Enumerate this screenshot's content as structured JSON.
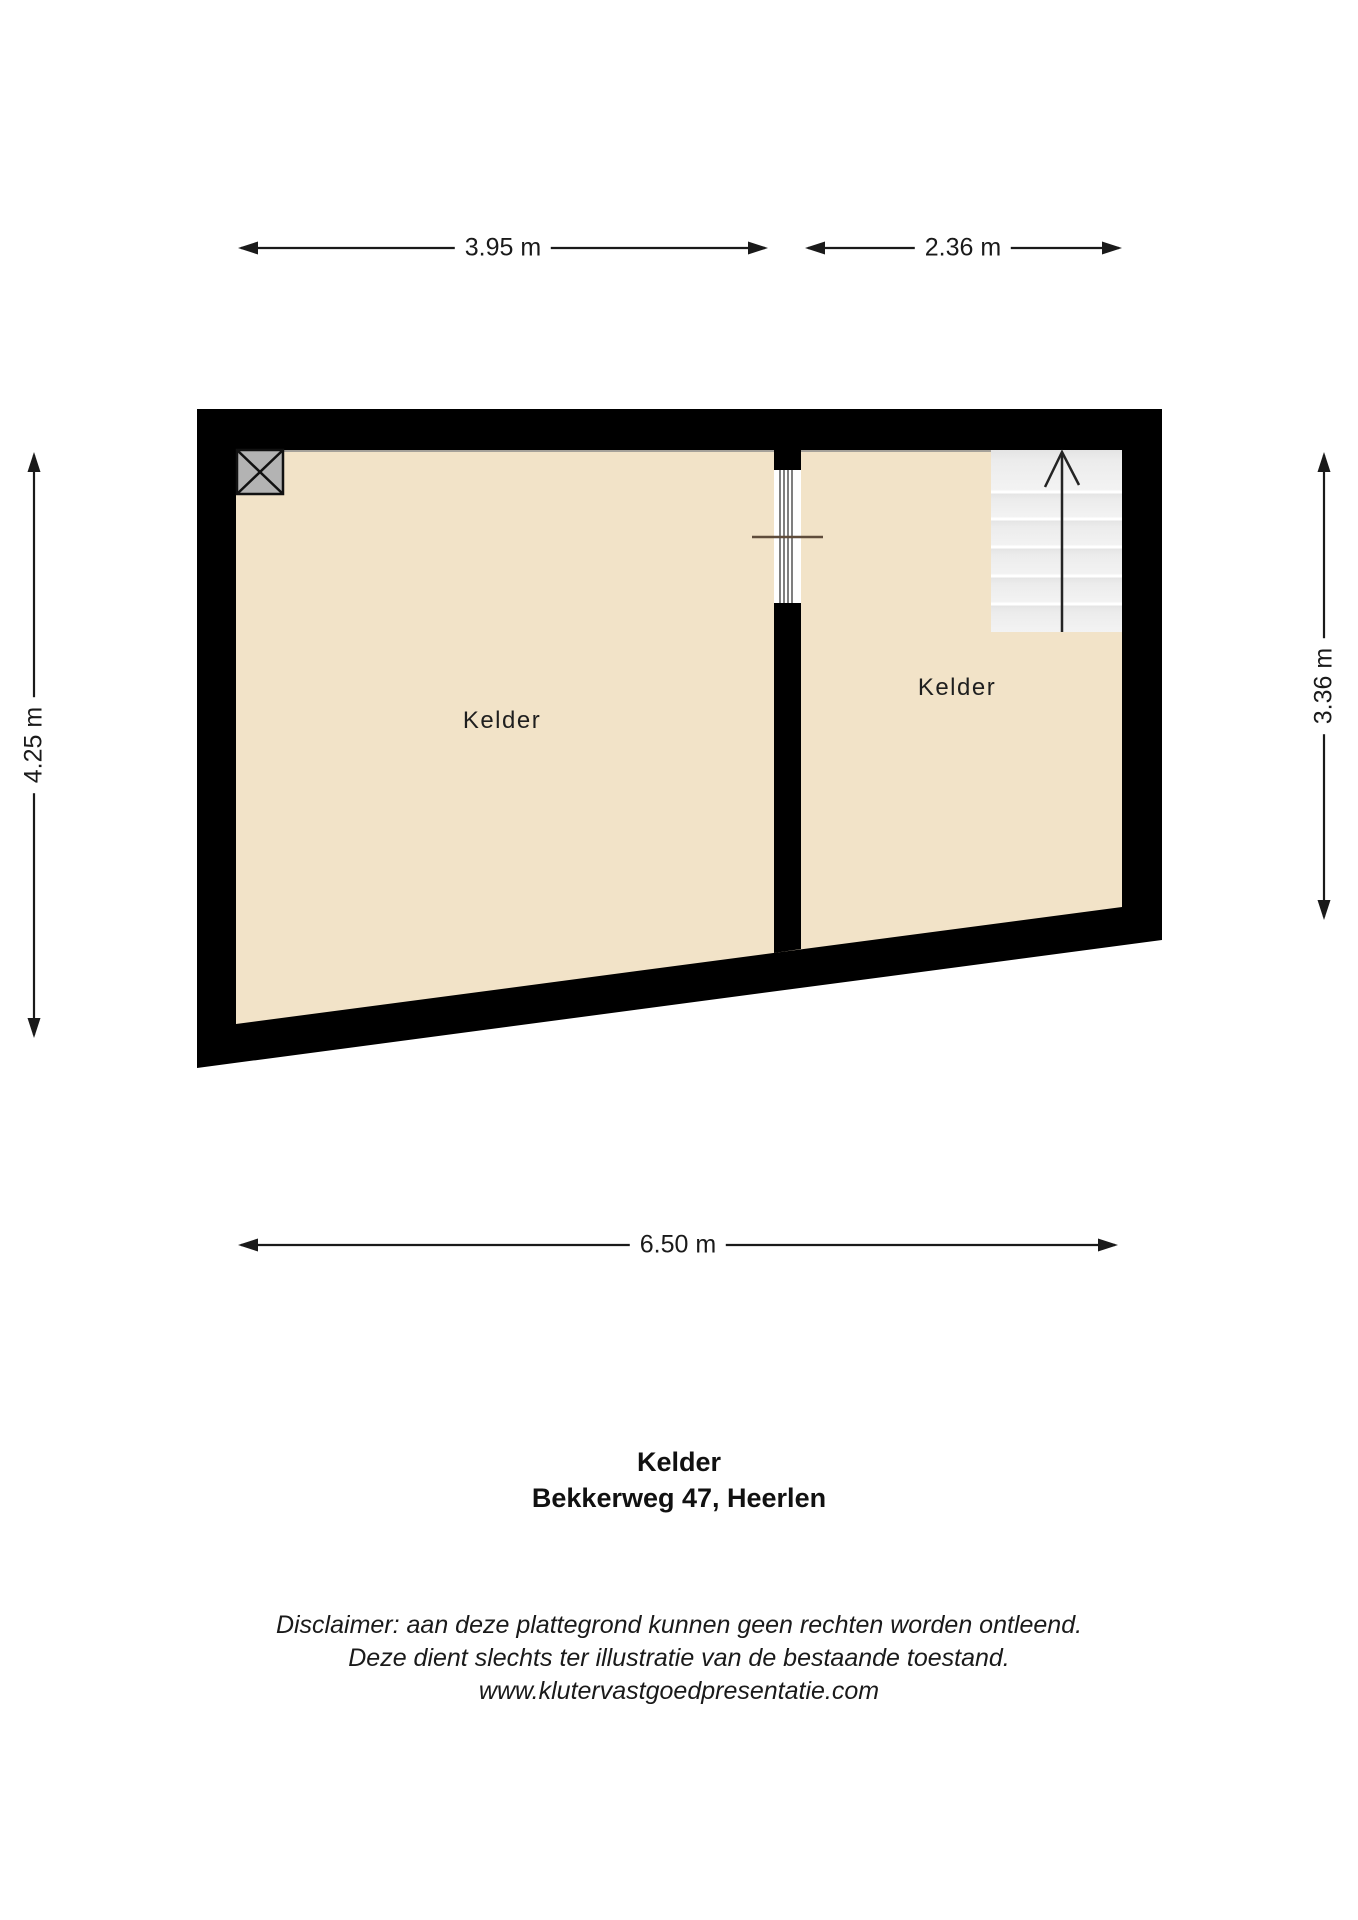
{
  "floorplan": {
    "dimensions": {
      "top_left": "3.95 m",
      "top_right": "2.36 m",
      "left": "4.25 m",
      "right": "3.36 m",
      "bottom": "6.50 m"
    },
    "rooms": {
      "left": {
        "label": "Kelder"
      },
      "right": {
        "label": "Kelder"
      }
    },
    "colors": {
      "wall": "#000000",
      "floor": "#f2e3c8",
      "stair_base": "#ececec",
      "shaft": "#b3b3b3",
      "door_swing_line": "#5f4c3b",
      "dimension_line": "#1a1a1a"
    }
  },
  "title": {
    "room": "Kelder",
    "address": "Bekkerweg 47, Heerlen"
  },
  "disclaimer": {
    "line1": "Disclaimer: aan deze plattegrond kunnen geen rechten worden ontleend.",
    "line2": "Deze dient slechts ter illustratie van de bestaande toestand.",
    "line3": "www.klutervastgoedpresentatie.com"
  }
}
